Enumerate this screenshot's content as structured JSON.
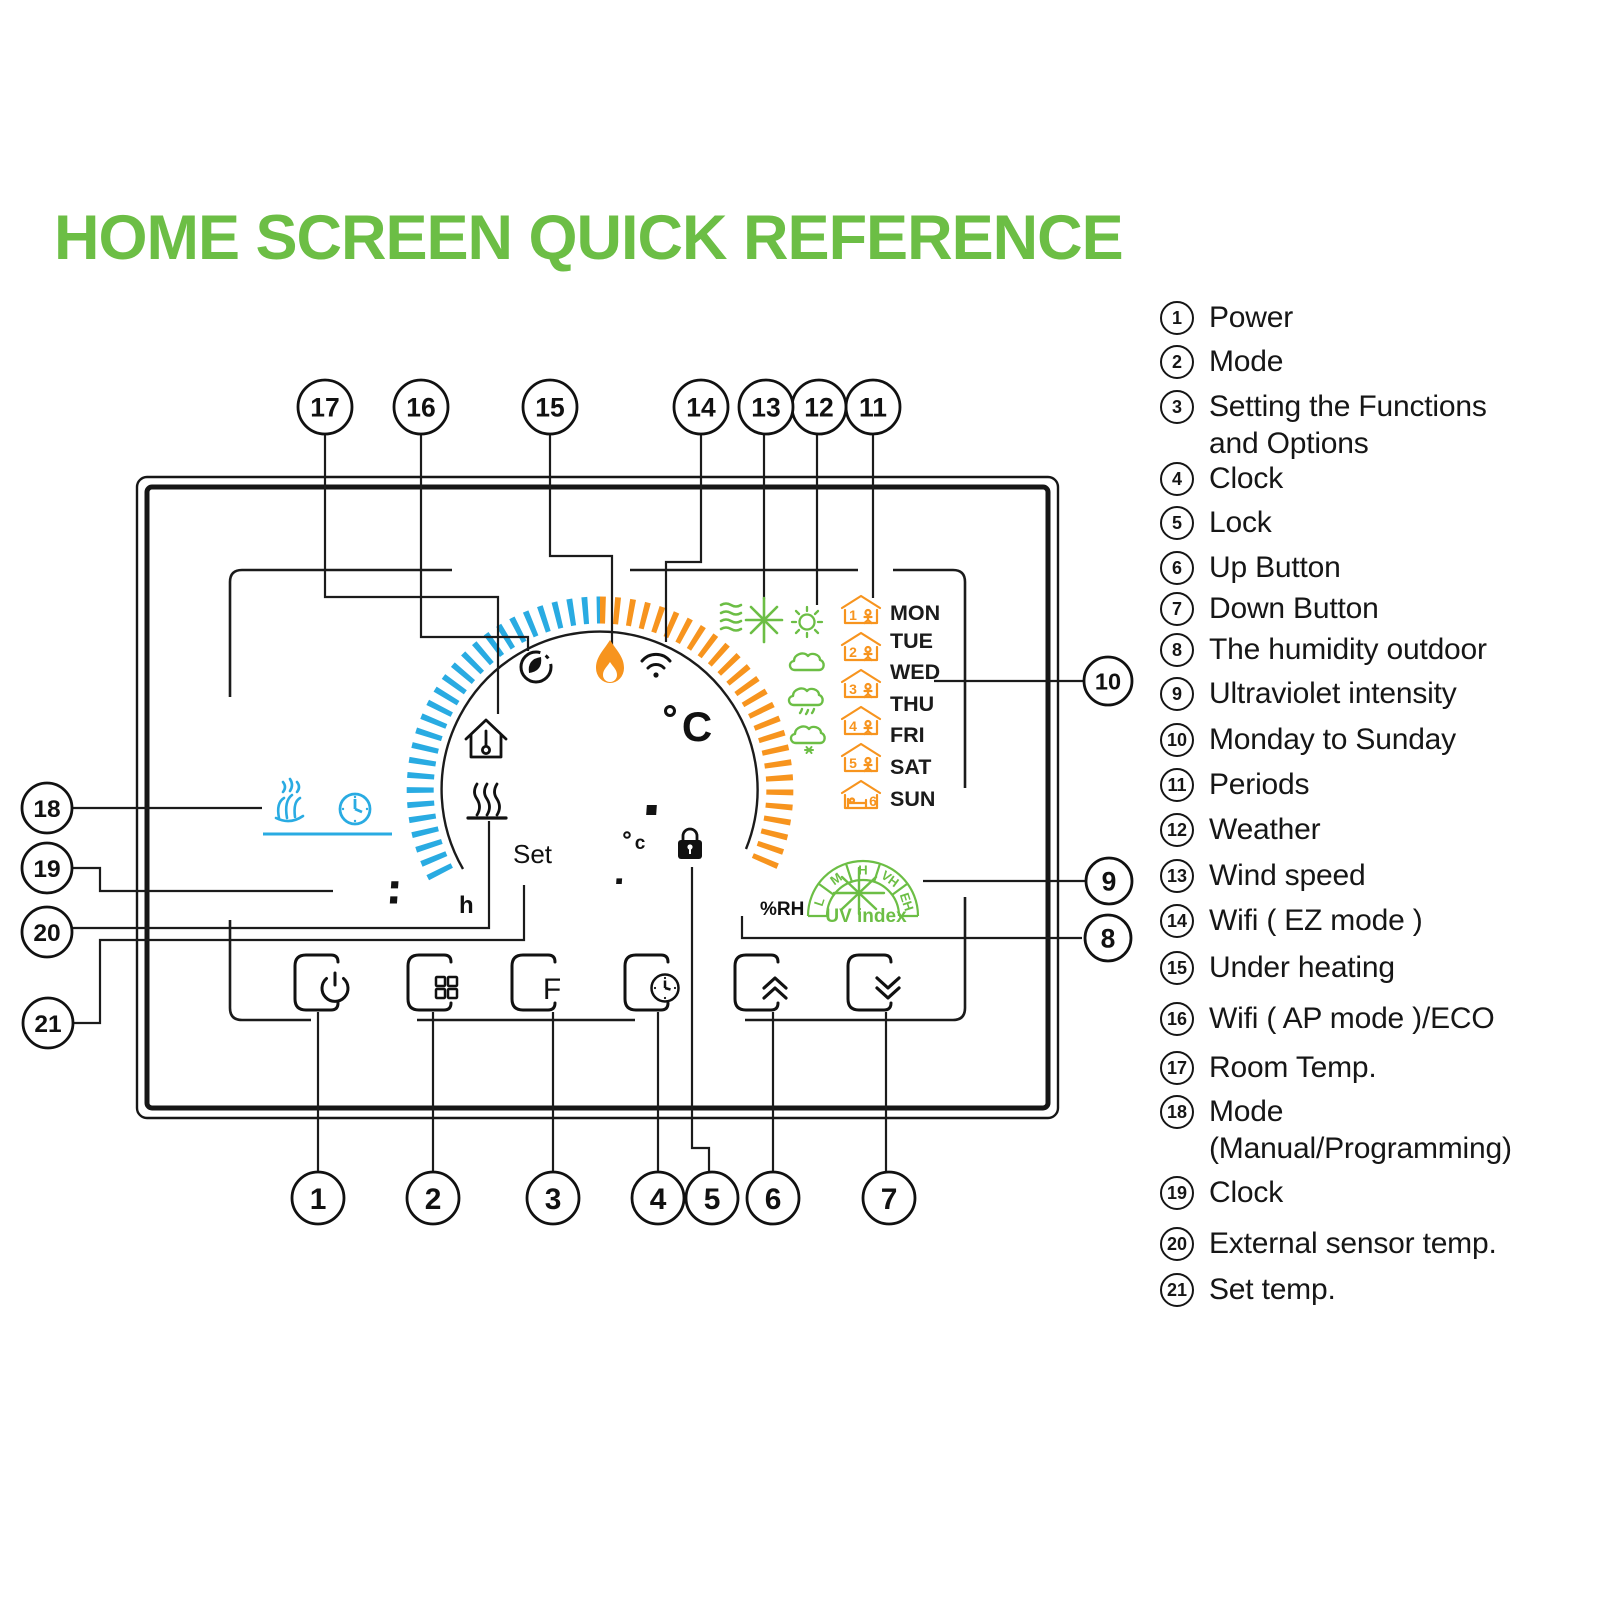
{
  "title": "HOME SCREEN QUICK REFERENCE",
  "colors": {
    "green": "#6CBE45",
    "blue": "#29ABE2",
    "orange": "#F7941E",
    "ink": "#1b1b1b"
  },
  "legend": {
    "items": [
      {
        "num": "1",
        "label": "Power"
      },
      {
        "num": "2",
        "label": "Mode"
      },
      {
        "num": "3",
        "label": "Setting the Functions\nand Options"
      },
      {
        "num": "4",
        "label": "Clock"
      },
      {
        "num": "5",
        "label": "Lock"
      },
      {
        "num": "6",
        "label": "Up Button"
      },
      {
        "num": "7",
        "label": "Down Button"
      },
      {
        "num": "8",
        "label": "The humidity outdoor"
      },
      {
        "num": "9",
        "label": "Ultraviolet intensity"
      },
      {
        "num": "10",
        "label": "Monday to Sunday"
      },
      {
        "num": "11",
        "label": "Periods"
      },
      {
        "num": "12",
        "label": "Weather"
      },
      {
        "num": "13",
        "label": "Wind speed"
      },
      {
        "num": "14",
        "label": "Wifi ( EZ mode )"
      },
      {
        "num": "15",
        "label": "Under heating"
      },
      {
        "num": "16",
        "label": "Wifi ( AP mode )/ECO"
      },
      {
        "num": "17",
        "label": "Room Temp."
      },
      {
        "num": "18",
        "label": "Mode\n(Manual/Programming)"
      },
      {
        "num": "19",
        "label": "Clock"
      },
      {
        "num": "20",
        "label": "External sensor temp."
      },
      {
        "num": "21",
        "label": "Set temp."
      }
    ]
  },
  "callouts": [
    "1",
    "2",
    "3",
    "4",
    "5",
    "6",
    "7",
    "8",
    "9",
    "10",
    "11",
    "12",
    "13",
    "14",
    "15",
    "16",
    "17",
    "18",
    "19",
    "20",
    "21"
  ],
  "display": {
    "room_temp_main": "88",
    "room_temp_frac": ".5",
    "room_temp_degree": "°",
    "room_temp_unit": "C",
    "set_label": "Set",
    "set_temp_main": "88",
    "set_temp_frac": ".5",
    "set_temp_unit": "c",
    "clock": "88:88",
    "clock_unit": "h",
    "humidity": "88",
    "humidity_unit": "%RH",
    "uv_label": "UV index",
    "uv_levels": [
      "L",
      "M",
      "H",
      "VH",
      "EH"
    ],
    "days": [
      "MON",
      "TUE",
      "WED",
      "THU",
      "FRI",
      "SAT",
      "SUN"
    ],
    "periods": [
      "1",
      "2",
      "3",
      "4",
      "5",
      "6"
    ],
    "function_button": "F"
  }
}
